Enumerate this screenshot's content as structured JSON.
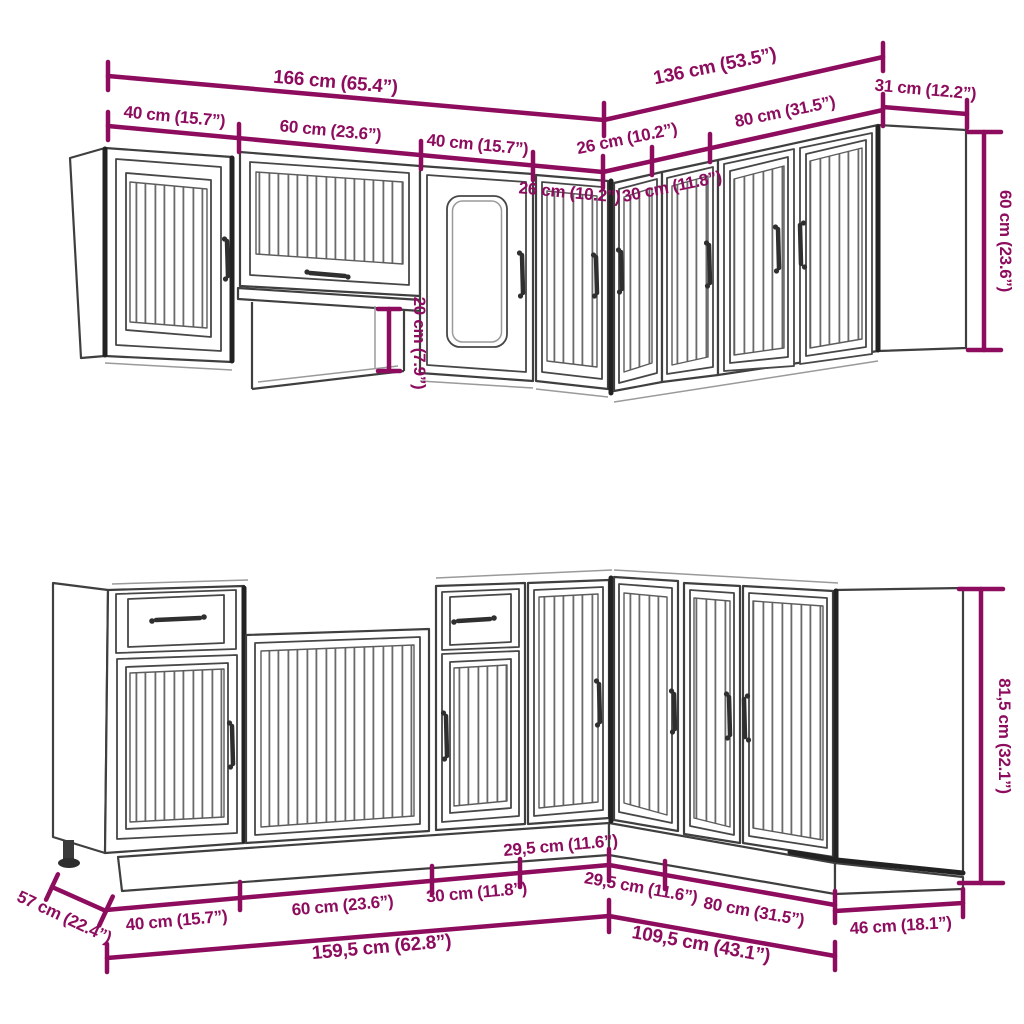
{
  "diagram_title": "kitchen-cabinet-set-dimension-drawing",
  "colors": {
    "dimension_accent": "#8d0c5e",
    "outline": "#3f3f3f",
    "background": "#ffffff"
  },
  "top": {
    "total_left": "166 cm (65.4”)",
    "seg_40a": "40 cm (15.7”)",
    "seg_60": "60 cm (23.6”)",
    "seg_40b": "40 cm (15.7”)",
    "seg_26_left": "26 cm (10.2”)",
    "total_right": "136 cm (53.5”)",
    "seg_26_right": "26 cm (10.2”)",
    "seg_30": "30 cm (11.8”)",
    "seg_80": "80 cm (31.5”)",
    "depth_right": "31 cm (12.2”)",
    "height": "60 cm (23.6”)",
    "niche_height": "20 cm (7.9”)"
  },
  "bottom": {
    "depth_left": "57 cm (22.4”)",
    "seg_40": "40 cm (15.7”)",
    "seg_60": "60 cm (23.6”)",
    "seg_30": "30 cm (11.8”)",
    "seg_295_corner": "29,5 cm (11.6”)",
    "seg_295_right": "29,5 cm (11.6”)",
    "seg_80": "80 cm (31.5”)",
    "depth_right": "46 cm (18.1”)",
    "total_left": "159,5 cm (62.8”)",
    "total_right": "109,5 cm (43.1”)",
    "height": "81,5 cm (32.1”)"
  }
}
